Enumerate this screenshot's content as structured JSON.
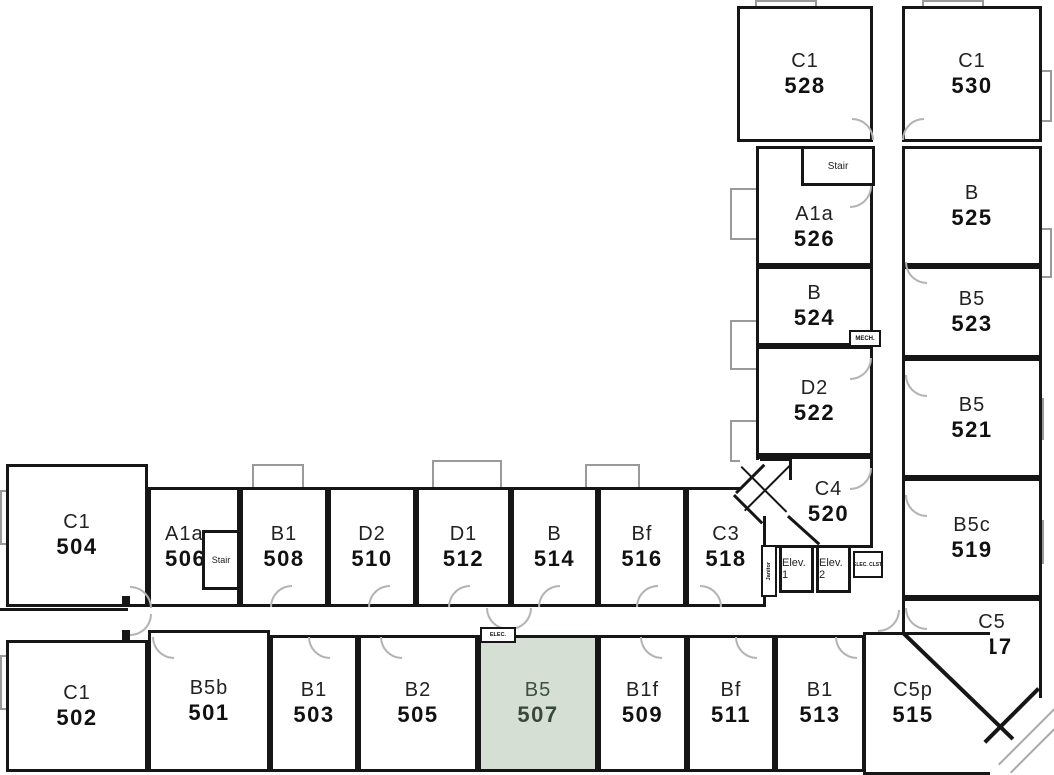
{
  "plan_title": "Residential floor plan, fifth floor units 501-530",
  "colors": {
    "wall": "#161616",
    "highlight_fill": "#d5dfd3",
    "highlight_text": "#3c4f44",
    "door_swing": "#b3b3b3"
  },
  "highlighted_unit": "507",
  "rooms": [
    {
      "type": "C1",
      "number": "528"
    },
    {
      "type": "C1",
      "number": "530"
    },
    {
      "type": "A1a",
      "number": "526"
    },
    {
      "type": "B",
      "number": "525"
    },
    {
      "type": "B",
      "number": "524"
    },
    {
      "type": "B5",
      "number": "523"
    },
    {
      "type": "D2",
      "number": "522"
    },
    {
      "type": "B5",
      "number": "521"
    },
    {
      "type": "C4",
      "number": "520"
    },
    {
      "type": "B5c",
      "number": "519"
    },
    {
      "type": "C5",
      "number": "517"
    },
    {
      "type": "C5p",
      "number": "515"
    },
    {
      "type": "C1",
      "number": "504"
    },
    {
      "type": "A1a",
      "number": "506"
    },
    {
      "type": "B1",
      "number": "508"
    },
    {
      "type": "D2",
      "number": "510"
    },
    {
      "type": "D1",
      "number": "512"
    },
    {
      "type": "B",
      "number": "514"
    },
    {
      "type": "Bf",
      "number": "516"
    },
    {
      "type": "C3",
      "number": "518"
    },
    {
      "type": "C1",
      "number": "502"
    },
    {
      "type": "B5b",
      "number": "501"
    },
    {
      "type": "B1",
      "number": "503"
    },
    {
      "type": "B2",
      "number": "505"
    },
    {
      "type": "B5",
      "number": "507",
      "highlighted": true
    },
    {
      "type": "B1f",
      "number": "509"
    },
    {
      "type": "Bf",
      "number": "511"
    },
    {
      "type": "B1",
      "number": "513"
    }
  ],
  "service": {
    "stair_upper": "Stair",
    "stair_lower": "Stair",
    "mech": "MECH.",
    "janitor": "Janitor",
    "elev_1": "Elev. 1",
    "elev_2": "Elev. 2",
    "elec_closet": "ELEC. CLST.",
    "elec": "ELEC."
  }
}
